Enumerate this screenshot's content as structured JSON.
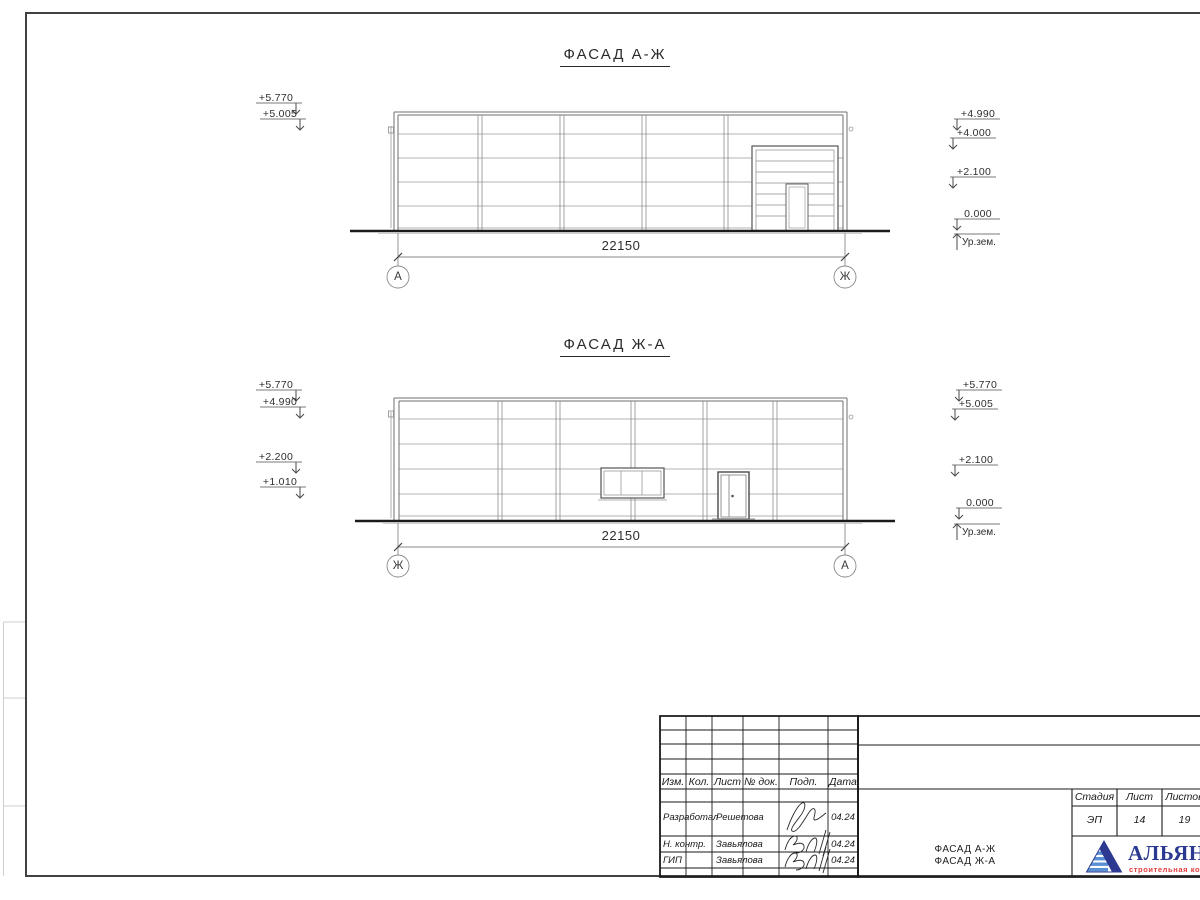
{
  "drawing": {
    "facade1": {
      "title": "ФАСАД А-Ж",
      "dimension": "22150",
      "axis_left": "А",
      "axis_right": "Ж",
      "marks_left": [
        "+5.770",
        "+5.005"
      ],
      "marks_right": [
        "+4.990",
        "+4.000",
        "+2.100",
        "0.000"
      ],
      "ground_label": "Ур.зем."
    },
    "facade2": {
      "title": "ФАСАД Ж-А",
      "dimension": "22150",
      "axis_left": "Ж",
      "axis_right": "А",
      "marks_left": [
        "+5.770",
        "+4.990",
        "+2.200",
        "+1.010"
      ],
      "marks_right": [
        "+5.770",
        "+5.005",
        "+2.100",
        "0.000"
      ],
      "ground_label": "Ур.зем."
    }
  },
  "titleblock": {
    "header_cols": [
      "Изм.",
      "Кол.",
      "Лист",
      "№ док.",
      "Подп.",
      "Дата"
    ],
    "rows": [
      {
        "role": "Разработал",
        "name": "Решетова",
        "date": "04.24"
      },
      {
        "role": "Н. контр.",
        "name": "Завьялова",
        "date": "04.24"
      },
      {
        "role": "ГИП",
        "name": "Завьялова",
        "date": "04.24"
      }
    ],
    "stage_label": "Стадия",
    "stage_value": "ЭП",
    "sheet_label": "Лист",
    "sheet_value": "14",
    "sheets_label": "Листов",
    "sheets_value": "19",
    "doc_title_line1": "ФАСАД А-Ж",
    "doc_title_line2": "ФАСАД Ж-А",
    "company_name": "АЛЬЯНС",
    "company_subtitle": "строительная компания",
    "colors": {
      "logo_blue": "#2b3990",
      "logo_light_blue": "#5b8fd4",
      "logo_red": "#e23b3e",
      "line_dark": "#1a1a1a"
    }
  }
}
